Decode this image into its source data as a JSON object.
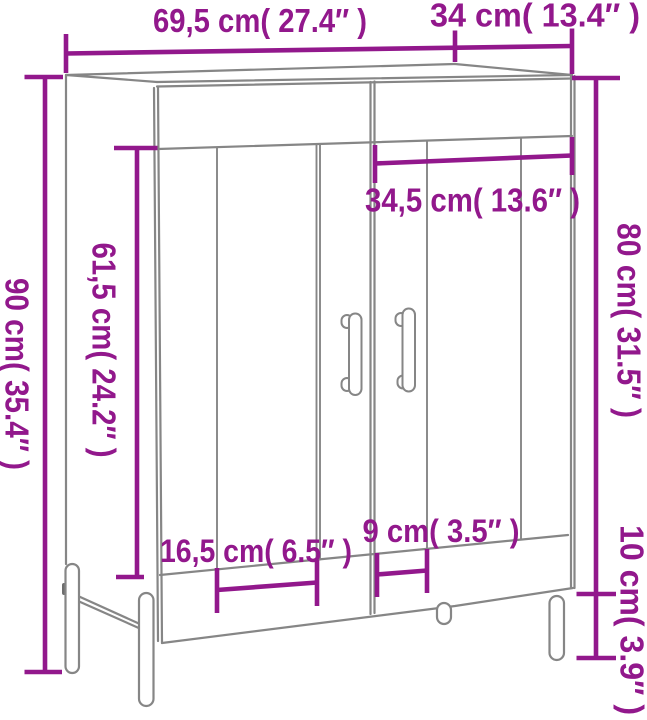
{
  "diagram": {
    "type": "furniture-dimension-diagram",
    "subject": "sideboard cabinet with two doors, two drawers and metal legs",
    "background_color": "#ffffff",
    "accent_color": "#92188C",
    "line_color": "#868686"
  },
  "dimensions": {
    "top_width": {
      "label": "69,5 cm( 27.4″ )",
      "cm": 69.5,
      "inches": 27.4,
      "orientation": "horizontal"
    },
    "top_depth": {
      "label": "34 cm( 13.4″ )",
      "cm": 34,
      "inches": 13.4,
      "orientation": "horizontal"
    },
    "overall_height": {
      "label": "90 cm( 35.4″ )",
      "cm": 90,
      "inches": 35.4,
      "orientation": "vertical"
    },
    "door_height": {
      "label": "61,5 cm( 24.2″ )",
      "cm": 61.5,
      "inches": 24.2,
      "orientation": "vertical"
    },
    "door_width": {
      "label": "34,5 cm( 13.6″ )",
      "cm": 34.5,
      "inches": 13.6,
      "orientation": "horizontal"
    },
    "body_height": {
      "label": "80 cm( 31.5″ )",
      "cm": 80,
      "inches": 31.5,
      "orientation": "vertical"
    },
    "leg_height": {
      "label": "10 cm( 3.9″ )",
      "cm": 10,
      "inches": 3.9,
      "orientation": "vertical"
    },
    "left_groove_span": {
      "label": "16,5 cm( 6.5″ )",
      "cm": 16.5,
      "inches": 6.5,
      "orientation": "horizontal"
    },
    "right_groove_span": {
      "label": "9 cm( 3.5″ )",
      "cm": 9,
      "inches": 3.5,
      "orientation": "horizontal"
    }
  }
}
